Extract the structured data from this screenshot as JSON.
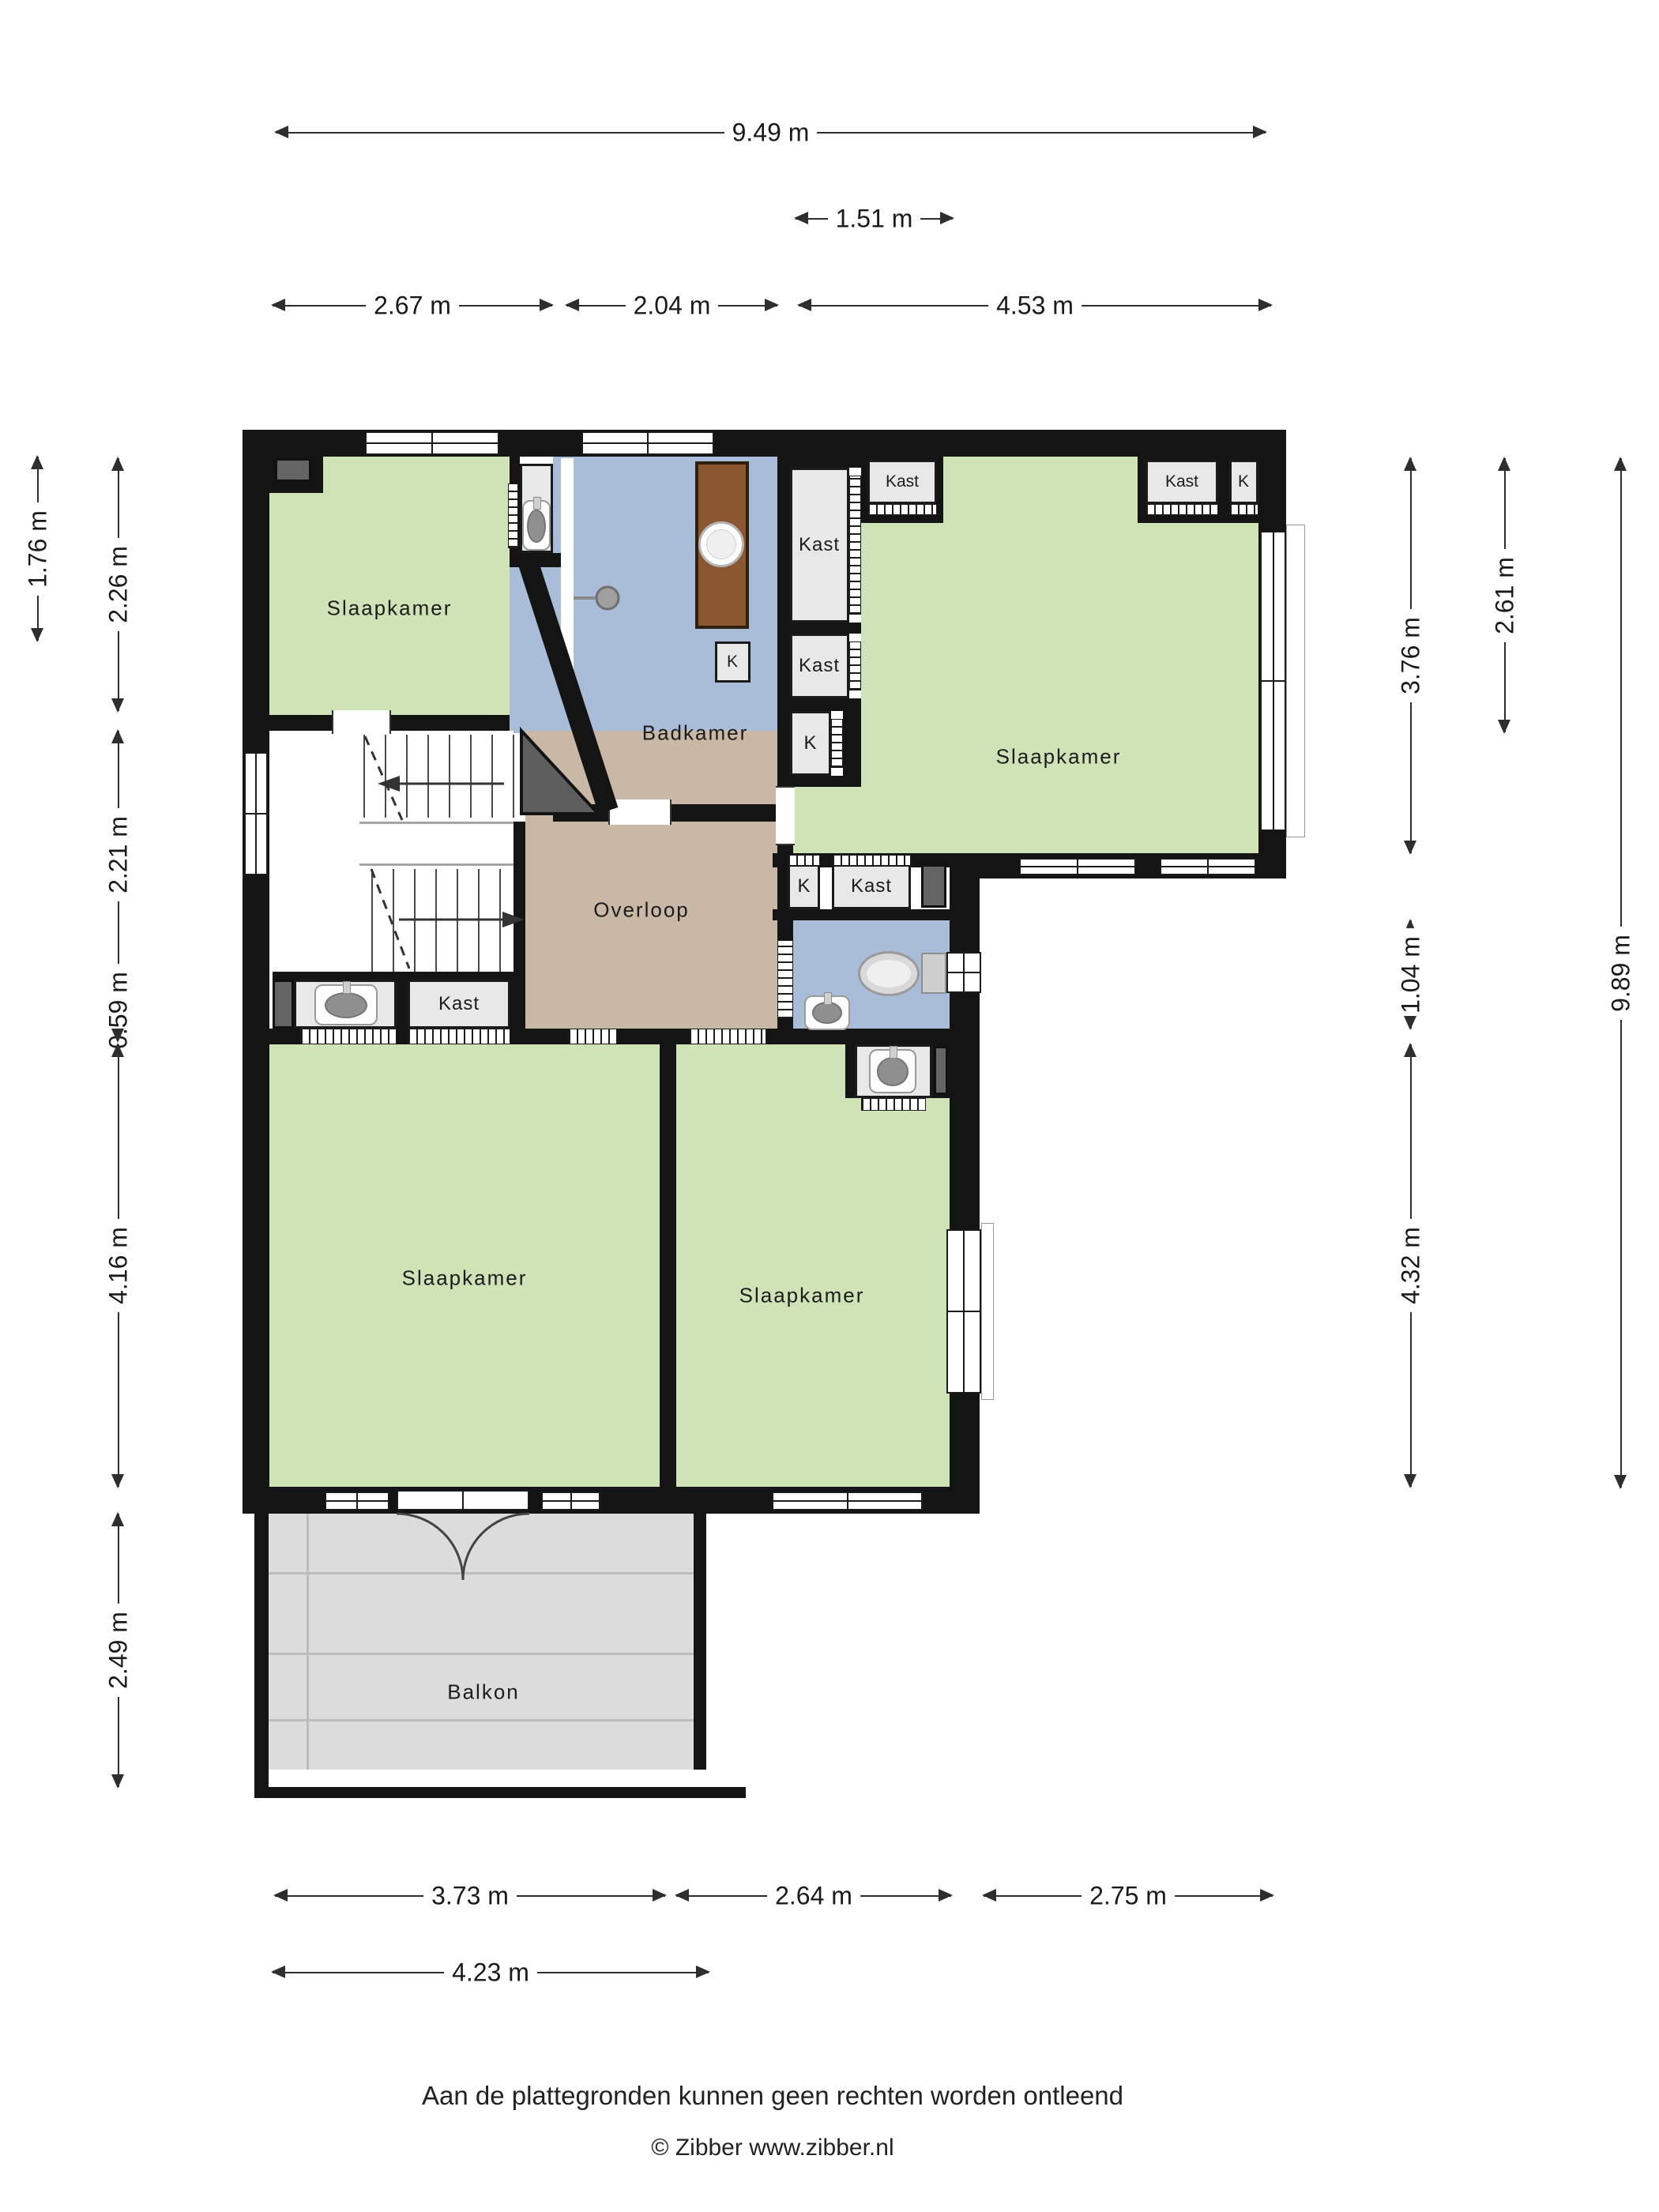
{
  "rooms": {
    "bedroom_top_left": "Slaapkamer",
    "bathroom": "Badkamer",
    "bedroom_right": "Slaapkamer",
    "landing": "Overloop",
    "bedroom_bottom_left": "Slaapkamer",
    "bedroom_bottom_right": "Slaapkamer",
    "balcony": "Balkon"
  },
  "labels": {
    "kast": "Kast",
    "k": "K"
  },
  "dims": {
    "d949": "9.49 m",
    "d151": "1.51 m",
    "d267": "2.67 m",
    "d204": "2.04 m",
    "d453": "4.53 m",
    "d176": "1.76 m",
    "d226": "2.26 m",
    "d221": "2.21 m",
    "d059": "0.59 m",
    "d416": "4.16 m",
    "d249": "2.49 m",
    "d376": "3.76 m",
    "d261": "2.61 m",
    "d104": "1.04 m",
    "d432": "4.32 m",
    "d989": "9.89 m",
    "d373": "3.73 m",
    "d264": "2.64 m",
    "d275": "2.75 m",
    "d423": "4.23 m"
  },
  "footer": {
    "disclaimer": "Aan de plattegronden kunnen geen rechten worden ontleend",
    "copyright": "© Zibber www.zibber.nl"
  },
  "colors": {
    "room_green": "#cfe3b6",
    "wet_room_blue": "#a9bdd8",
    "landing_tan": "#c9b8a5",
    "balcony_gray": "#dcdcdc",
    "wall_black": "#141414",
    "wood_brown": "#8a5730"
  }
}
